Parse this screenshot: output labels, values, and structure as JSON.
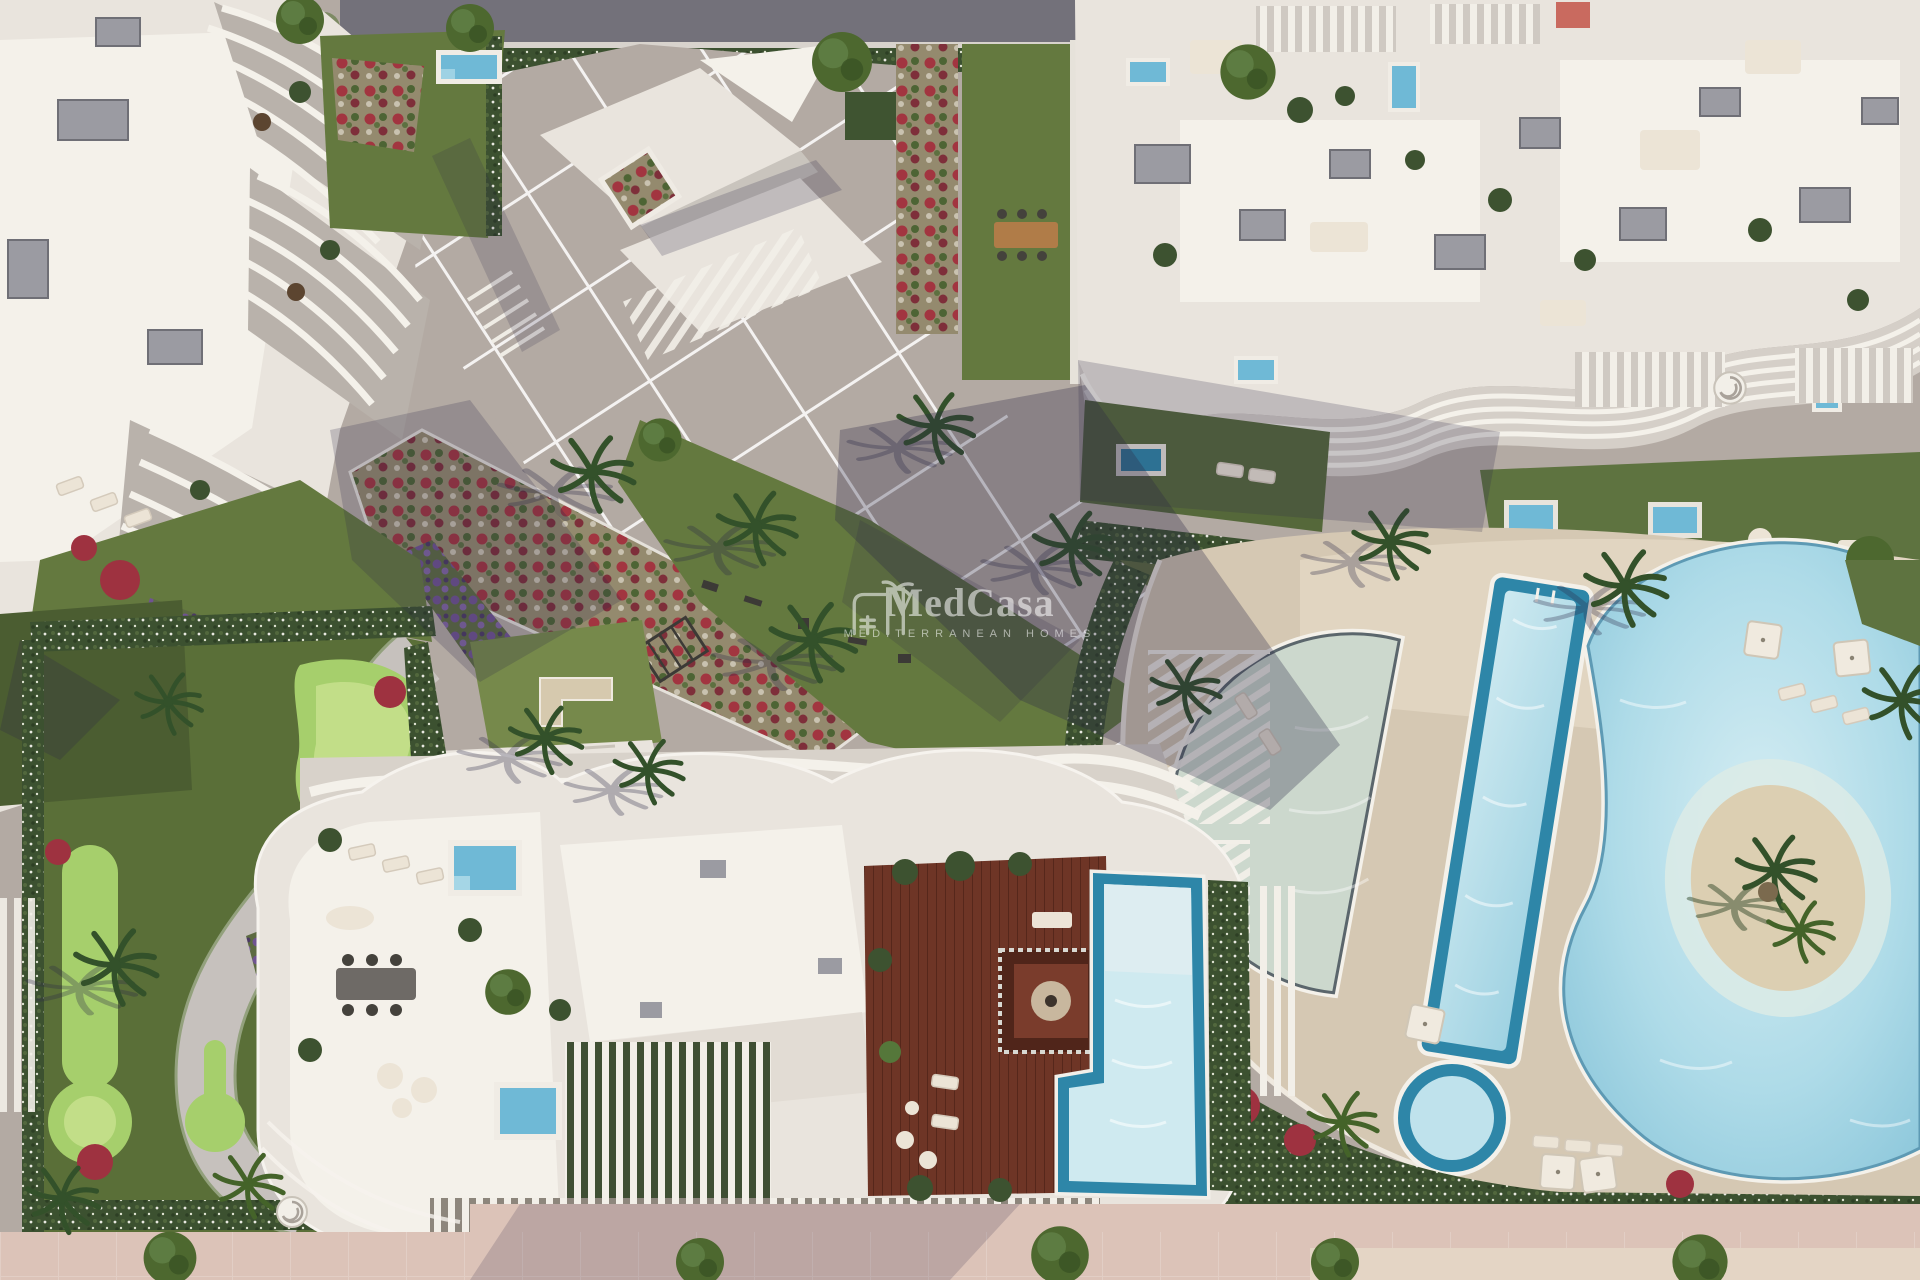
{
  "watermark": {
    "brand": "MedCasa",
    "tagline": "MEDITERRANEAN HOMES",
    "icon": "house-with-palm-icon",
    "color": "#ffffff",
    "opacity": 0.55
  },
  "palette": {
    "road": "#73717a",
    "plaza": "#b3aaa3",
    "plaza_dark": "#9f9792",
    "building": "#e9e4dd",
    "building_bright": "#f4f1ea",
    "roofbox": "#9b9ba2",
    "roofbox_dark": "#77777e",
    "grass": "#64793f",
    "grass_dark": "#4b5d31",
    "lawn_bright": "#76894b",
    "golf": "#5a6f38",
    "golf_light": "#a6cf6c",
    "golf_lighter": "#c2de88",
    "deck": "#d5c8b3",
    "deck_light": "#e1d5c1",
    "wood": "#6e3526",
    "wood_dark": "#50251a",
    "pool_pale": "#cfeaf0",
    "pool_blue": "#6fb9d6",
    "pool_teal": "#2e86a8",
    "lagoon": "#9fd2e0",
    "shallow_pool": "#ccd8cd",
    "sand": "#dccfb2",
    "promenade": "#dcc3b8",
    "promenade_dark": "#c9aba0",
    "hedge": "#3d5230",
    "flower_red": "#9e3240",
    "flower_purple": "#6f5391",
    "flower_white": "#cfc9b8",
    "furniture": "#ece4d6",
    "canopy": "#3f5431",
    "wood_table": "#b07c48",
    "shadow": "#2c2947",
    "tree": "#4d682f",
    "palm": "#33512a"
  }
}
